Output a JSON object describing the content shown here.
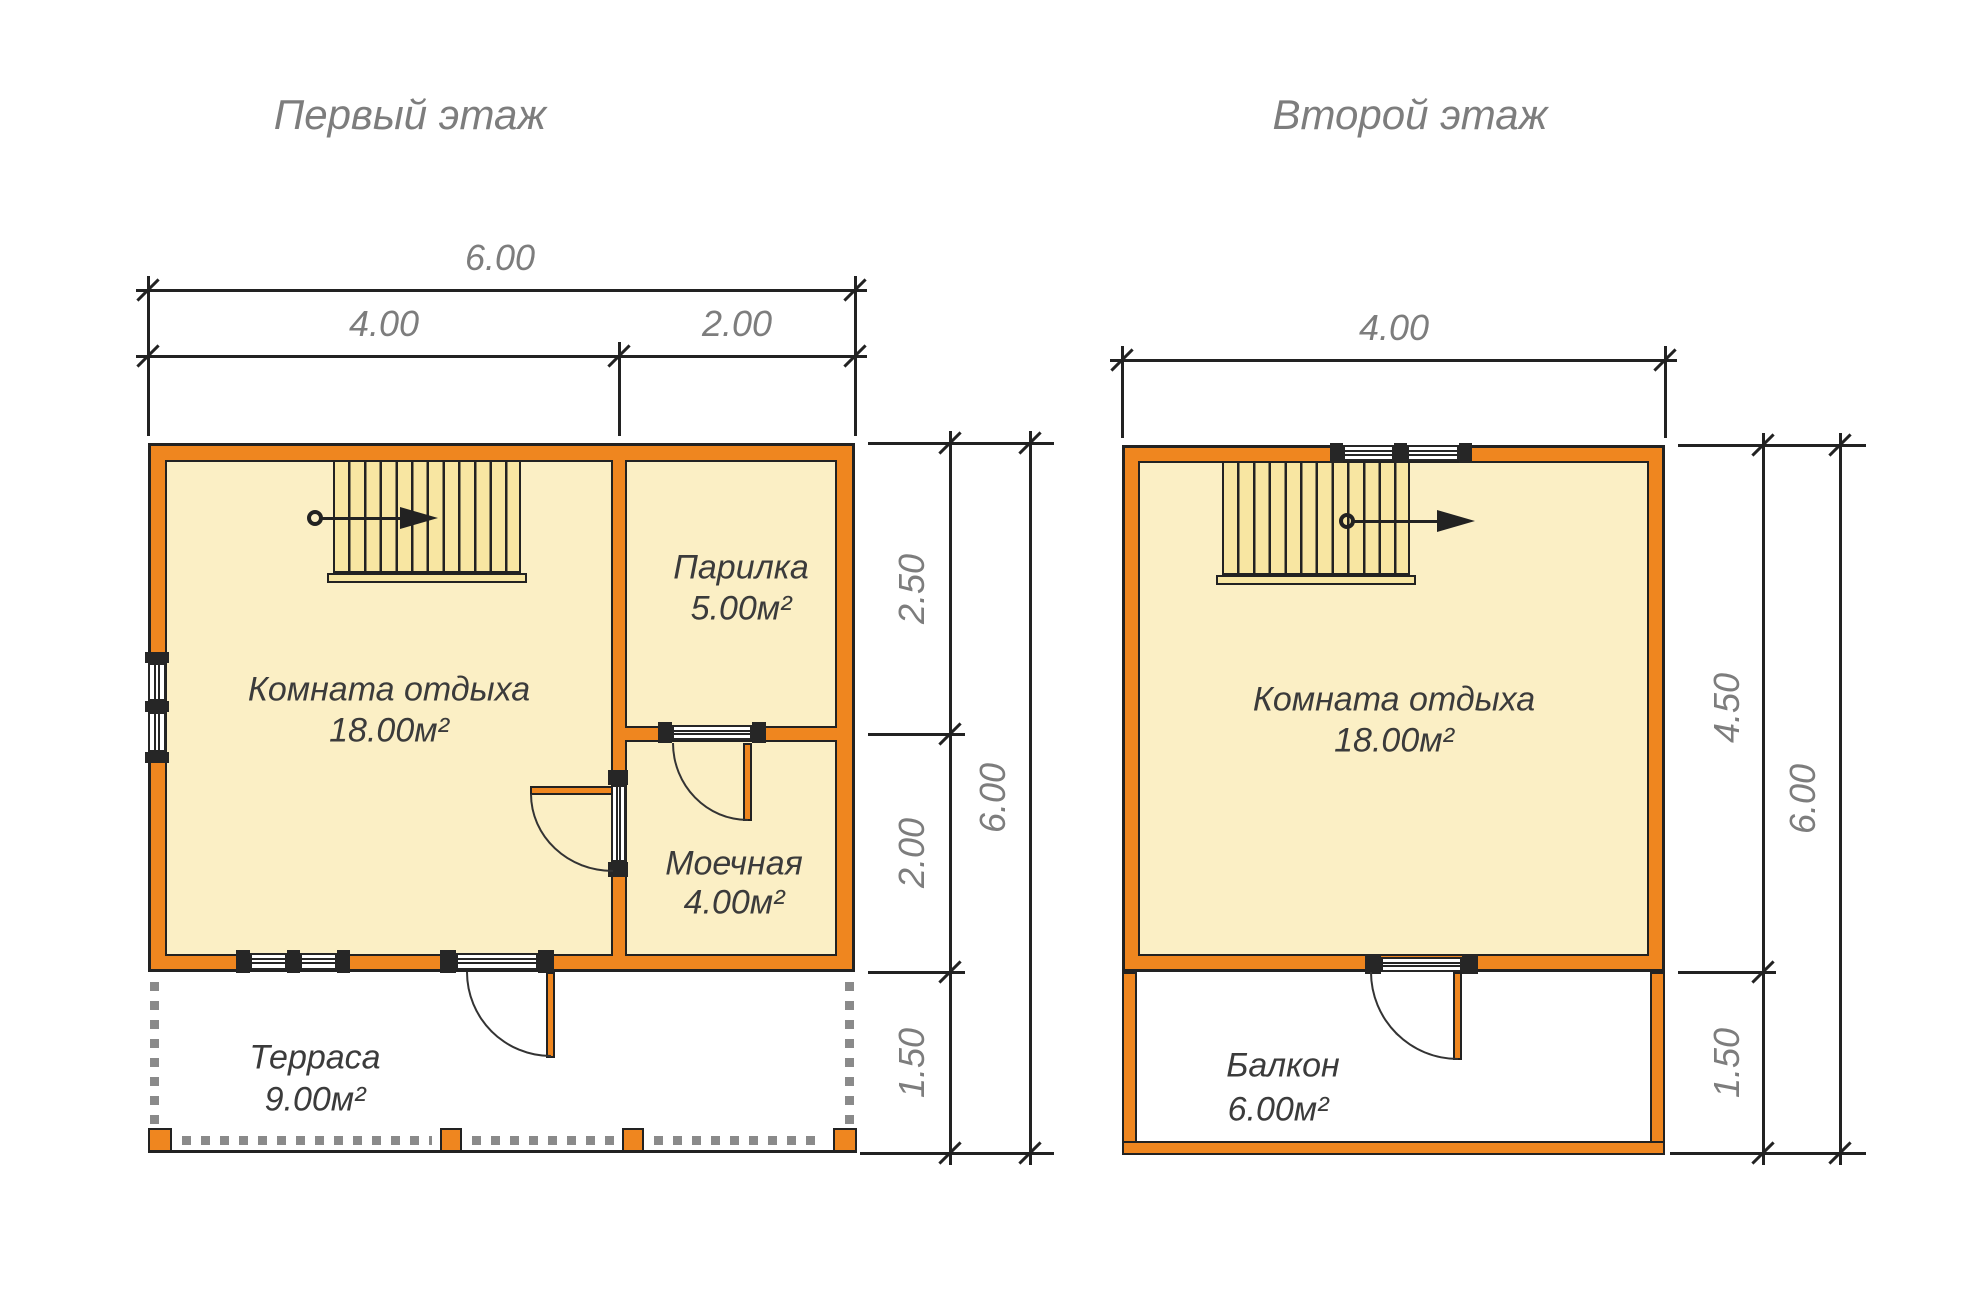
{
  "colors": {
    "wall_orange": "#EF861F",
    "floor_fill": "#FBEFC5",
    "stair_fill": "#F8E6A2",
    "dim_text": "#7d7d7d",
    "room_text": "#3b3b3b",
    "outline": "#222222"
  },
  "floor1": {
    "title": "Первый этаж",
    "rooms": [
      {
        "name": "Комната отдыха",
        "area": "18.00м²"
      },
      {
        "name": "Парилка",
        "area": "5.00м²"
      },
      {
        "name": "Моечная",
        "area": "4.00м²"
      },
      {
        "name": "Терраса",
        "area": "9.00м²"
      }
    ],
    "dims": {
      "top_total": "6.00",
      "top_left": "4.00",
      "top_right": "2.00",
      "right_top": "2.50",
      "right_mid": "2.00",
      "right_bottom": "1.50",
      "right_total": "6.00"
    }
  },
  "floor2": {
    "title": "Второй этаж",
    "rooms": [
      {
        "name": "Комната отдыха",
        "area": "18.00м²"
      },
      {
        "name": "Балкон",
        "area": "6.00м²"
      }
    ],
    "dims": {
      "top": "4.00",
      "right_top": "4.50",
      "right_bottom": "1.50",
      "right_total": "6.00"
    }
  }
}
